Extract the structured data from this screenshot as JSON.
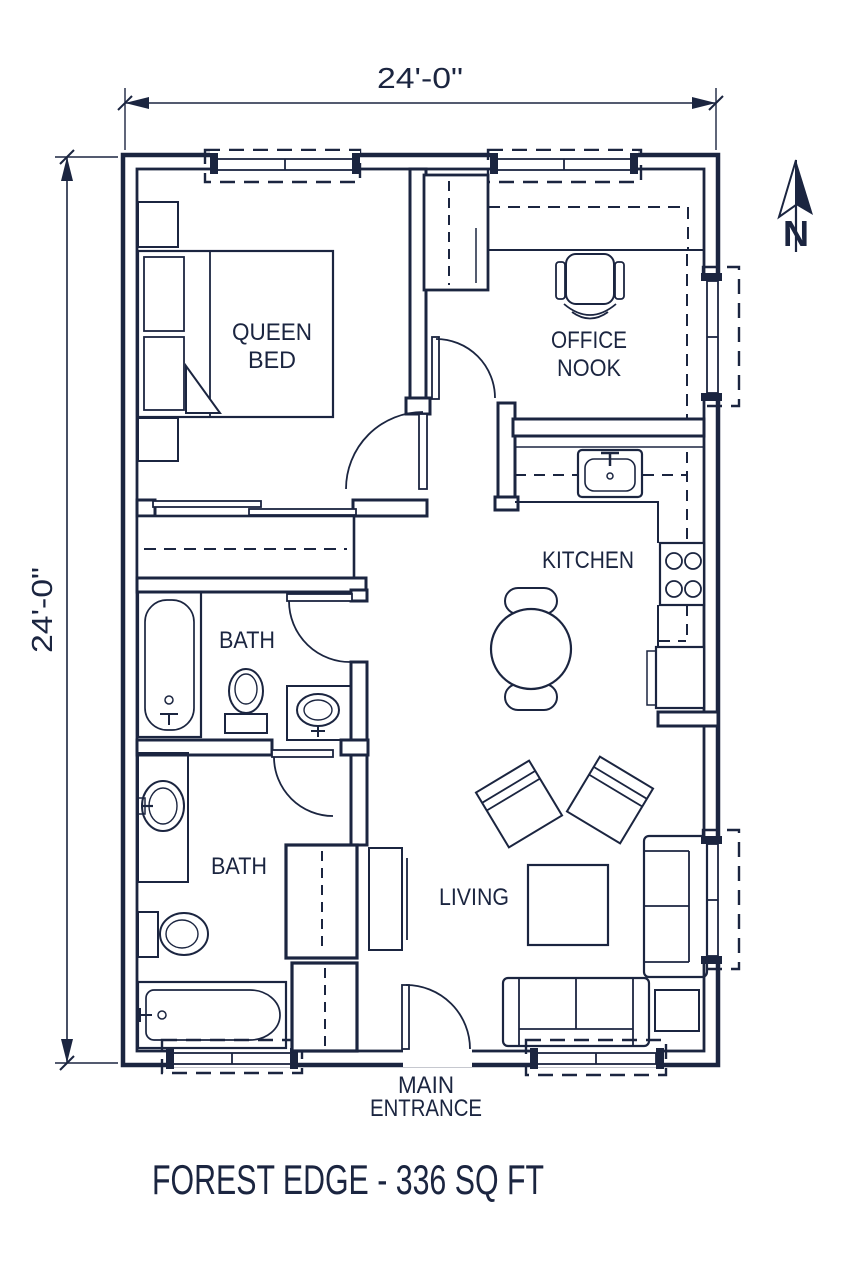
{
  "plan": {
    "title": "FOREST EDGE - 336 SQ FT",
    "dimension_top": "24'-0\"",
    "dimension_left": "24'-0\"",
    "north_label": "N",
    "rooms": {
      "bedroom": {
        "line1": "QUEEN",
        "line2": "BED"
      },
      "office_nook": {
        "line1": "OFFICE",
        "line2": "NOOK"
      },
      "kitchen": {
        "label": "KITCHEN"
      },
      "bath_middle": {
        "label": "BATH"
      },
      "bath_lower": {
        "label": "BATH"
      },
      "living": {
        "label": "LIVING"
      },
      "main_entrance": {
        "line1": "MAIN",
        "line2": "ENTRANCE"
      }
    },
    "colors": {
      "ink": "#1b2540",
      "paper": "#ffffff"
    }
  }
}
